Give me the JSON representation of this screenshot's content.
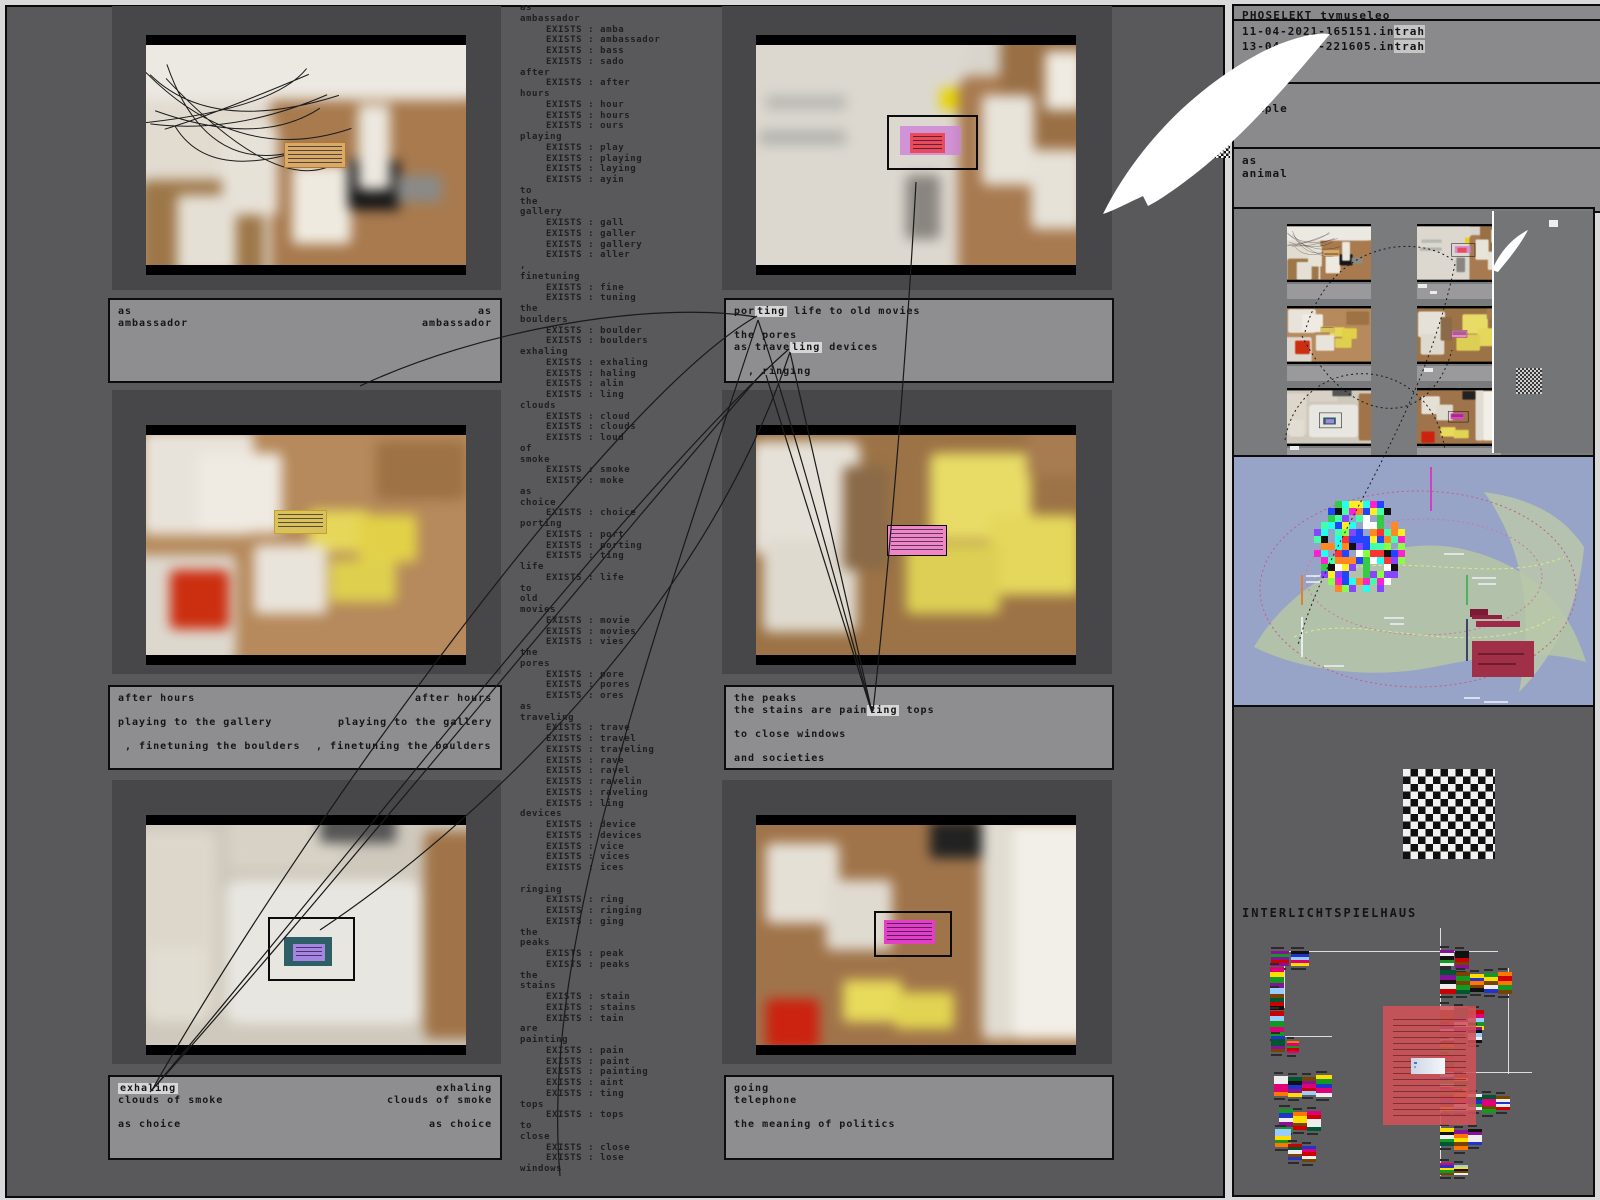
{
  "header": {
    "title": "PHOSELEKT tymuseleo"
  },
  "files": [
    {
      "pre": "11-04-2021-165151.in",
      "hl": "trah"
    },
    {
      "pre": "13-04-2021-221605.in",
      "hl": "trah"
    }
  ],
  "labels": {
    "temple": "the\ntemple",
    "animal": "as\nanimal",
    "interlicht": "INTERLICHTSPIELHAUS"
  },
  "exists_label": "EXISTS : ",
  "word_list": [
    [
      "as"
    ],
    [
      "ambassador",
      [
        "amba",
        "ambassador",
        "bass",
        "sado"
      ]
    ],
    [
      "after",
      [
        "after"
      ]
    ],
    [
      "hours",
      [
        "hour",
        "hours",
        "ours"
      ]
    ],
    [
      "playing",
      [
        "play",
        "playing",
        "laying",
        "ayin"
      ]
    ],
    [
      "to"
    ],
    [
      "the"
    ],
    [
      "gallery",
      [
        "gall",
        "galler",
        "gallery",
        "aller"
      ]
    ],
    [
      ","
    ],
    [
      "finetuning",
      [
        "fine",
        "tuning"
      ]
    ],
    [
      "the"
    ],
    [
      "boulders",
      [
        "boulder",
        "boulders"
      ]
    ],
    [
      "exhaling",
      [
        "exhaling",
        "haling",
        "alin",
        "ling"
      ]
    ],
    [
      "clouds",
      [
        "cloud",
        "clouds",
        "loud"
      ]
    ],
    [
      "of"
    ],
    [
      "smoke",
      [
        "smoke",
        "moke"
      ]
    ],
    [
      "as"
    ],
    [
      "choice",
      [
        "choice"
      ]
    ],
    [
      "porting",
      [
        "port",
        "porting",
        "ting"
      ]
    ],
    [
      "life",
      [
        "life"
      ]
    ],
    [
      "to"
    ],
    [
      "old"
    ],
    [
      "movies",
      [
        "movie",
        "movies",
        "vies"
      ]
    ],
    [
      "the"
    ],
    [
      "pores",
      [
        "pore",
        "pores",
        "ores"
      ]
    ],
    [
      "as"
    ],
    [
      "traveling",
      [
        "trave",
        "travel",
        "traveling",
        "rave",
        "ravel",
        "ravelin",
        "raveling",
        "ling"
      ]
    ],
    [
      "devices",
      [
        "device",
        "devices",
        "vice",
        "vices",
        "ices"
      ]
    ],
    [
      ""
    ],
    [
      "ringing",
      [
        "ring",
        "ringing",
        "ging"
      ]
    ],
    [
      "the"
    ],
    [
      "peaks",
      [
        "peak",
        "peaks"
      ]
    ],
    [
      "the"
    ],
    [
      "stains",
      [
        "stain",
        "stains",
        "tain"
      ]
    ],
    [
      "are"
    ],
    [
      "painting",
      [
        "pain",
        "paint",
        "painting",
        "aint",
        "ting"
      ]
    ],
    [
      "tops",
      [
        "tops"
      ]
    ],
    [
      "to"
    ],
    [
      "close",
      [
        "close",
        "lose"
      ]
    ],
    [
      "windows"
    ]
  ],
  "captions": [
    {
      "mirror": true,
      "lines": [
        [
          {
            "t": "as"
          }
        ],
        [
          {
            "t": "ambassador"
          }
        ]
      ]
    },
    {
      "mirror": true,
      "lines": [
        [
          {
            "t": "after hours"
          }
        ],
        [],
        [
          {
            "t": "playing to the gallery"
          }
        ],
        [],
        [
          {
            "t": " , finetuning the boulders"
          }
        ]
      ]
    },
    {
      "mirror": true,
      "lines": [
        [
          {
            "t": "exhaling",
            "h": 1
          }
        ],
        [
          {
            "t": "clouds of smoke"
          }
        ],
        [],
        [
          {
            "t": "as choice"
          }
        ]
      ]
    },
    {
      "mirror": false,
      "lines": [
        [
          {
            "t": "por"
          },
          {
            "t": "ting",
            "h": 1
          },
          {
            "t": " life to old movies"
          }
        ],
        [],
        [
          {
            "t": "the pores"
          }
        ],
        [
          {
            "t": "as trave"
          },
          {
            "t": "ling",
            "h": 1
          },
          {
            "t": " devices"
          }
        ],
        [],
        [
          {
            "t": "  , ringing"
          }
        ]
      ]
    },
    {
      "mirror": false,
      "lines": [
        [
          {
            "t": "the peaks"
          }
        ],
        [
          {
            "t": "the stains are pain"
          },
          {
            "t": "ting",
            "h": 1
          },
          {
            "t": " tops"
          }
        ],
        [],
        [
          {
            "t": "to close windows"
          }
        ],
        [],
        [
          {
            "t": "and societies"
          }
        ]
      ]
    },
    {
      "mirror": false,
      "lines": [
        [
          {
            "t": "going"
          }
        ],
        [
          {
            "t": "telephone"
          }
        ],
        [],
        [
          {
            "t": "the meaning of politics"
          }
        ]
      ]
    }
  ],
  "videos": [
    {
      "bg": "#e2dbd0",
      "net": true,
      "sel": null,
      "blobs": [
        [
          40,
          20,
          70,
          85,
          "#a87a4e"
        ],
        [
          2,
          60,
          36,
          55,
          "#9d7748"
        ],
        [
          26,
          38,
          16,
          36,
          "#e7e2d8"
        ],
        [
          46,
          54,
          17,
          32,
          "#efeae0"
        ],
        [
          13,
          66,
          17,
          32,
          "#e5e0d6"
        ],
        [
          62,
          52,
          15,
          20,
          "#141414"
        ],
        [
          65,
          30,
          9,
          34,
          "#ece8e0"
        ],
        [
          76,
          58,
          13,
          11,
          "#8a8a88"
        ],
        [
          0,
          0,
          100,
          28,
          "#ece8e2"
        ]
      ],
      "notes": [
        [
          43,
          44,
          19,
          11,
          "#d8aa68",
          1,
          "#b5763a"
        ]
      ]
    },
    {
      "bg": "#d9d5cc",
      "net": false,
      "sel": [
        41,
        32,
        27,
        23
      ],
      "blobs": [
        [
          0,
          0,
          64,
          100,
          "#dcd8cf"
        ],
        [
          62,
          18,
          40,
          84,
          "#a87a50"
        ],
        [
          74,
          0,
          28,
          46,
          "#996f45"
        ],
        [
          69,
          26,
          15,
          36,
          "#e8e4da"
        ],
        [
          83,
          48,
          15,
          32,
          "#e6e2d8"
        ],
        [
          87,
          8,
          11,
          24,
          "#efebe2"
        ],
        [
          7,
          26,
          23,
          6,
          "#b9b9b4"
        ],
        [
          5,
          40,
          25,
          6,
          "#b4b4af"
        ],
        [
          57,
          23,
          5,
          9,
          "#e8d400"
        ],
        [
          47,
          58,
          10,
          26,
          "#8a8580"
        ]
      ],
      "notes": [
        [
          45,
          37,
          19,
          13,
          "rgba(205,130,215,0.8)",
          0,
          null
        ],
        [
          48,
          40,
          11,
          9,
          "#ea4a5a",
          1,
          null
        ]
      ]
    },
    {
      "bg": "#b68a5c",
      "net": false,
      "sel": null,
      "blobs": [
        [
          3,
          4,
          32,
          42,
          "#e8e3da"
        ],
        [
          19,
          13,
          24,
          32,
          "#efeae2"
        ],
        [
          0,
          54,
          30,
          44,
          "#ddd8ce"
        ],
        [
          11,
          60,
          17,
          24,
          "#cc2e10"
        ],
        [
          51,
          36,
          17,
          17,
          "#e6d75a"
        ],
        [
          65,
          38,
          17,
          19,
          "#e2d148"
        ],
        [
          57,
          56,
          19,
          17,
          "#ded04e"
        ],
        [
          35,
          50,
          21,
          28,
          "#e9e4db"
        ],
        [
          70,
          8,
          26,
          24,
          "#9d7244"
        ]
      ],
      "notes": [
        [
          40,
          34,
          16,
          10,
          "#d9c15c",
          1,
          "#bfa030"
        ]
      ]
    },
    {
      "bg": "#9c7346",
      "net": false,
      "sel": null,
      "blobs": [
        [
          54,
          13,
          29,
          35,
          "#e8dc66"
        ],
        [
          71,
          38,
          26,
          32,
          "#e5d75c"
        ],
        [
          47,
          49,
          27,
          29,
          "#ddcf55"
        ],
        [
          3,
          8,
          31,
          46,
          "#e6e1d8"
        ],
        [
          6,
          48,
          27,
          37,
          "#dfdacf"
        ],
        [
          29,
          18,
          13,
          42,
          "#8a6a48"
        ],
        [
          82,
          2,
          16,
          20,
          "#a67c50"
        ]
      ],
      "notes": [
        [
          41,
          41,
          18,
          13,
          "#ef86c6",
          1,
          "#0b0b0b"
        ]
      ]
    },
    {
      "bg": "#cfc9bd",
      "net": false,
      "sel": [
        38,
        42,
        26,
        27
      ],
      "blobs": [
        [
          27,
          28,
          56,
          58,
          "#e8e6e0"
        ],
        [
          1,
          8,
          23,
          74,
          "#ddd7cb"
        ],
        [
          28,
          3,
          32,
          20,
          "#d8d2c6"
        ],
        [
          84,
          8,
          16,
          84,
          "#a07448"
        ],
        [
          54,
          0,
          22,
          13,
          "#555555"
        ],
        [
          5,
          55,
          16,
          30,
          "#e2ddd2"
        ]
      ],
      "notes": [
        [
          43,
          51,
          15,
          13,
          "#2e5f66",
          0,
          null
        ],
        [
          46,
          54,
          10,
          8,
          "#a584e2",
          1,
          null
        ]
      ]
    },
    {
      "bg": "#a87c50",
      "net": false,
      "sel": [
        37,
        39,
        23,
        19
      ],
      "blobs": [
        [
          0,
          0,
          72,
          100,
          "#a0744a"
        ],
        [
          77,
          4,
          23,
          88,
          "#f2efe8"
        ],
        [
          69,
          0,
          9,
          92,
          "#e0dcd2"
        ],
        [
          7,
          13,
          21,
          32,
          "#e5e0d6"
        ],
        [
          24,
          28,
          19,
          28,
          "#e0dbd1"
        ],
        [
          54,
          4,
          15,
          15,
          "#222222"
        ],
        [
          7,
          76,
          15,
          20,
          "#cc2210"
        ],
        [
          29,
          68,
          17,
          17,
          "#e8da5a"
        ],
        [
          44,
          73,
          17,
          15,
          "#e2d452"
        ]
      ],
      "notes": [
        [
          40,
          43,
          16,
          11,
          "#e23ec8",
          1,
          null
        ]
      ]
    }
  ],
  "edges": [
    "M152,1090 C300,830 610,400 757,316",
    "M152,1090 C330,880 640,480 789,349",
    "M150,1092 C280,950 590,570 763,372",
    "M872,712 C835,580 795,430 758,320",
    "M872,712 L790,352",
    "M872,713 L766,375",
    "M873,711 C892,540 908,330 916,182",
    "M790,352 C700,620 470,830 320,930",
    "M758,320 C650,650 540,950 560,1176",
    "M360,386 C480,330 650,300 756,317"
  ],
  "dotted": [
    "M1305,332 C1330,240 1420,232 1455,262",
    "M1302,336 C1350,430 1430,430 1452,350",
    "M1455,264 C1420,430 1330,530 1298,645",
    "M1285,440 C1300,350 1430,350 1445,450"
  ],
  "arrows": [
    "M1103,214 C1135,150 1190,90 1262,52 C1290,38 1316,32 1330,34 C1300,70 1250,130 1200,170 C1180,186 1160,200 1148,206 L1143,196 C1130,202 1115,210 1103,214 Z",
    "M1492,270 C1500,252 1512,238 1528,230 C1520,246 1506,262 1498,272 Z"
  ],
  "flag_palette": [
    "#cc0000",
    "#ffdd00",
    "#2233cc",
    "#119922",
    "#881199",
    "#ff7700",
    "#111111",
    "#eeeeee",
    "#dd0077",
    "#005533",
    "#99ccff",
    "#774400"
  ],
  "flags": [
    [
      1271,
      951,
      15,
      18
    ],
    [
      1291,
      951,
      15,
      18
    ],
    [
      1270,
      967,
      26,
      14
    ],
    [
      1270,
      990,
      20,
      14
    ],
    [
      1270,
      1011,
      26,
      14
    ],
    [
      1271,
      1036,
      16,
      14
    ],
    [
      1287,
      1041,
      12,
      12
    ],
    [
      1274,
      1076,
      20,
      14
    ],
    [
      1288,
      1077,
      20,
      14
    ],
    [
      1302,
      1077,
      18,
      14
    ],
    [
      1316,
      1075,
      22,
      16
    ],
    [
      1279,
      1109,
      22,
      16
    ],
    [
      1293,
      1112,
      18,
      14
    ],
    [
      1307,
      1111,
      20,
      14
    ],
    [
      1275,
      1129,
      18,
      16
    ],
    [
      1288,
      1144,
      16,
      14
    ],
    [
      1302,
      1146,
      16,
      14
    ],
    [
      1440,
      950,
      16,
      14
    ],
    [
      1455,
      951,
      18,
      14
    ],
    [
      1440,
      970,
      24,
      16
    ],
    [
      1456,
      972,
      22,
      14
    ],
    [
      1470,
      974,
      18,
      14
    ],
    [
      1484,
      973,
      20,
      14
    ],
    [
      1498,
      972,
      22,
      14
    ],
    [
      1440,
      1006,
      22,
      14
    ],
    [
      1454,
      1008,
      24,
      14
    ],
    [
      1468,
      1010,
      20,
      16
    ],
    [
      1440,
      1026,
      14,
      14
    ],
    [
      1468,
      1027,
      16,
      14
    ],
    [
      1440,
      1041,
      14,
      14
    ],
    [
      1440,
      1056,
      16,
      14
    ],
    [
      1440,
      1073,
      18,
      14
    ],
    [
      1454,
      1075,
      16,
      14
    ],
    [
      1440,
      1091,
      20,
      14
    ],
    [
      1454,
      1093,
      18,
      14
    ],
    [
      1468,
      1094,
      16,
      14
    ],
    [
      1482,
      1095,
      18,
      14
    ],
    [
      1496,
      1096,
      14,
      14
    ],
    [
      1440,
      1128,
      18,
      14
    ],
    [
      1454,
      1130,
      20,
      14
    ],
    [
      1468,
      1129,
      16,
      14
    ],
    [
      1440,
      1163,
      12,
      14
    ],
    [
      1454,
      1165,
      10,
      14
    ]
  ],
  "ilh_lines": [
    [
      1278,
      951,
      220,
      1
    ],
    [
      1440,
      928,
      1,
      248
    ],
    [
      1284,
      956,
      1,
      52
    ],
    [
      1272,
      1036,
      60,
      1
    ],
    [
      1508,
      968,
      1,
      106
    ],
    [
      1440,
      1072,
      92,
      1
    ]
  ],
  "colors": {
    "canvas": "#59595b",
    "panel": "#47474a",
    "caption_bg": "#8e8e90",
    "rp_bg": "#8a8a8c",
    "rp_low": "#5e5e60",
    "viz_bg": "#97a4c7",
    "edge": "#191919",
    "red_box": "rgba(207,82,88,0.88)"
  }
}
